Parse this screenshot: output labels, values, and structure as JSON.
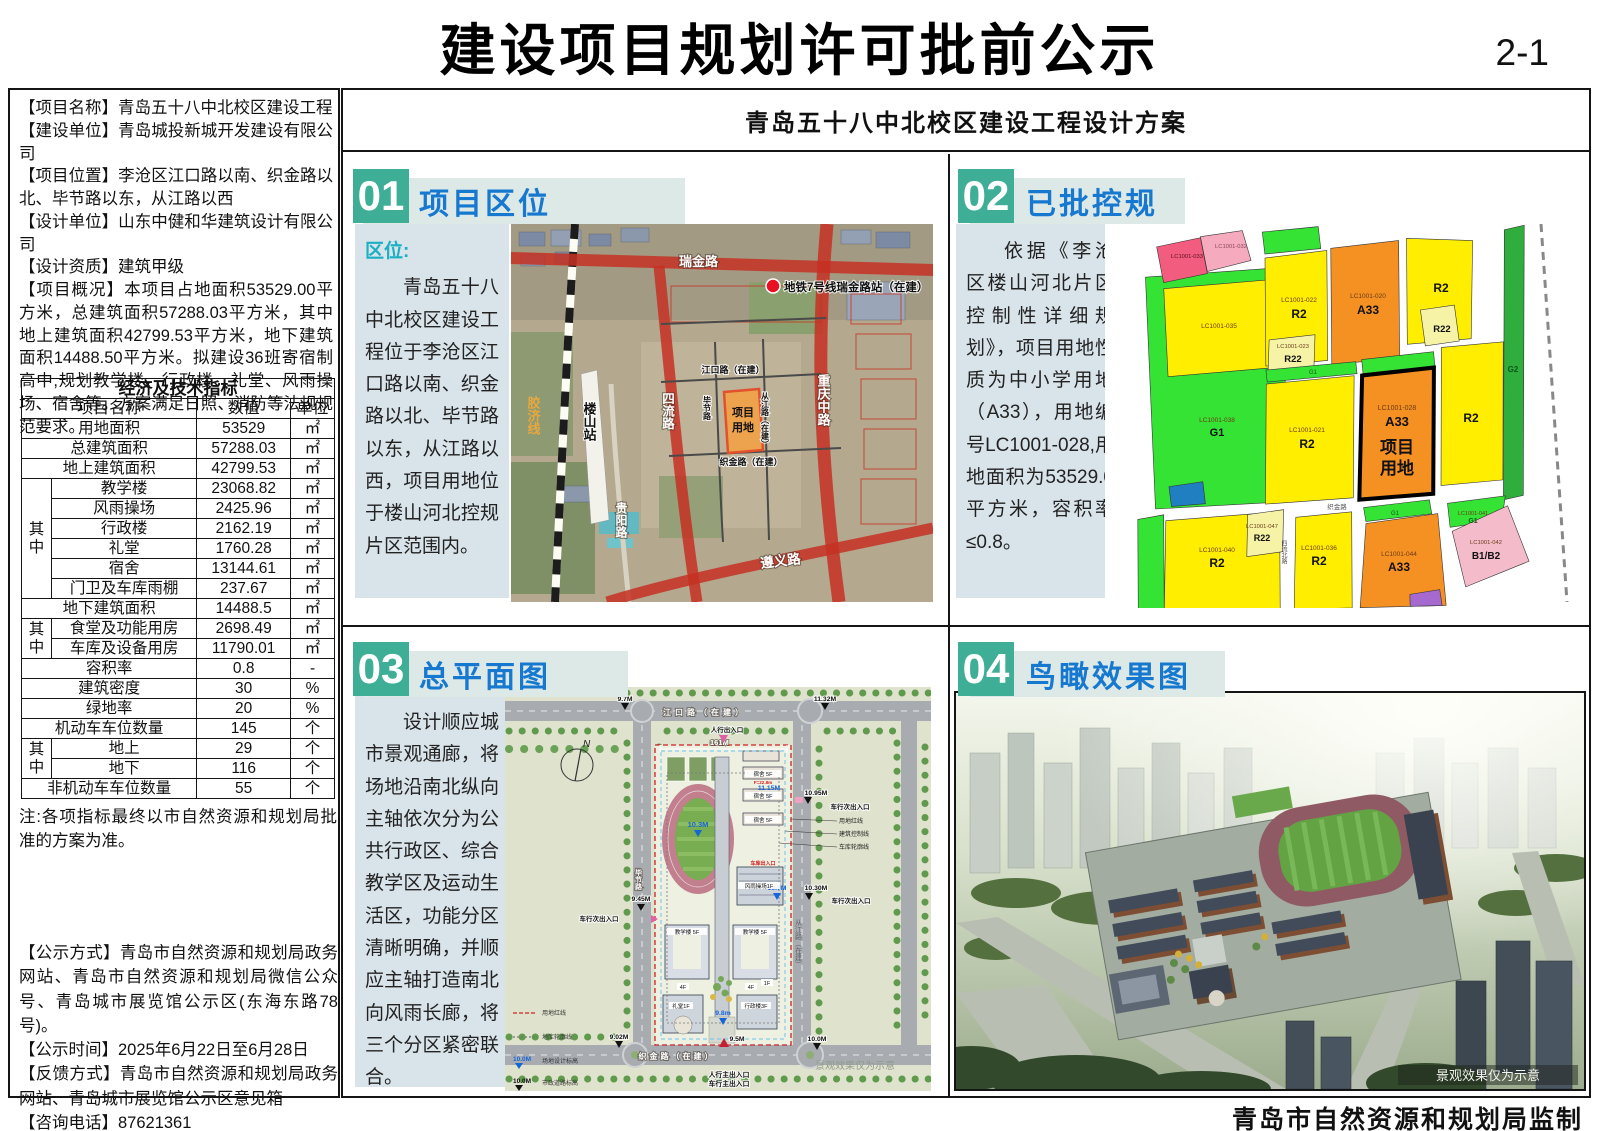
{
  "page": {
    "title": "建设项目规划许可批前公示",
    "page_no": "2-1",
    "subtitle": "青岛五十八中北校区建设工程设计方案",
    "footer": "青岛市自然资源和规划局监制"
  },
  "colors": {
    "badge_teal": "#3fae96",
    "header_blue": "#1778d0",
    "banner_bg": "#dde9e7",
    "card_bg": "#d8e3ea",
    "accent_cyan": "#1ab0c4",
    "zoning": {
      "r2": "#ffee00",
      "r22": "#f6f3a6",
      "a33": "#f59122",
      "g1": "#35e335",
      "g2": "#2fae3e",
      "pink": "#f25c7e",
      "light_pink": "#f5abbd",
      "b1b2": "#f4bcca",
      "blue": "#1f7fc0",
      "purple": "#a569cf"
    }
  },
  "sidebar": {
    "info": [
      {
        "label": "【项目名称】",
        "text": "青岛五十八中北校区建设工程"
      },
      {
        "label": "【建设单位】",
        "text": "青岛城投新城开发建设有限公司"
      },
      {
        "label": "【项目位置】",
        "text": "李沧区江口路以南、织金路以北、毕节路以东，从江路以西"
      },
      {
        "label": "【设计单位】",
        "text": "山东中健和华建筑设计有限公司"
      },
      {
        "label": "【设计资质】",
        "text": "建筑甲级"
      },
      {
        "label": "【项目概况】",
        "text": "本项目占地面积53529.00平方米，总建筑面积57288.03平方米，其中地上建筑面积42799.53平方米，地下建筑面积14488.50平方米。拟建设36班寄宿制高中,规划教学楼、行政楼、礼堂、风雨操场、宿舍等。方案满足日照、消防等法规规范要求。"
      }
    ],
    "table": {
      "title": "经济及技术指标",
      "headers": [
        "项目名称",
        "数值",
        "单位"
      ],
      "rows": [
        {
          "name": "用地面积",
          "value": "53529",
          "unit": "㎡"
        },
        {
          "name": "总建筑面积",
          "value": "57288.03",
          "unit": "㎡"
        },
        {
          "name": "地上建筑面积",
          "value": "42799.53",
          "unit": "㎡"
        },
        {
          "group": "其中",
          "name": "教学楼",
          "value": "23068.82",
          "unit": "㎡"
        },
        {
          "name": "风雨操场",
          "value": "2425.96",
          "unit": "㎡"
        },
        {
          "name": "行政楼",
          "value": "2162.19",
          "unit": "㎡"
        },
        {
          "name": "礼堂",
          "value": "1760.28",
          "unit": "㎡"
        },
        {
          "name": "宿舍",
          "value": "13144.61",
          "unit": "㎡"
        },
        {
          "name": "门卫及车库雨棚",
          "value": "237.67",
          "unit": "㎡"
        },
        {
          "name": "地下建筑面积",
          "value": "14488.5",
          "unit": "㎡"
        },
        {
          "group": "其中",
          "name": "食堂及功能用房",
          "value": "2698.49",
          "unit": "㎡"
        },
        {
          "name": "车库及设备用房",
          "value": "11790.01",
          "unit": "㎡"
        },
        {
          "name": "容积率",
          "value": "0.8",
          "unit": "-"
        },
        {
          "name": "建筑密度",
          "value": "30",
          "unit": "%"
        },
        {
          "name": "绿地率",
          "value": "20",
          "unit": "%"
        },
        {
          "name": "机动车车位数量",
          "value": "145",
          "unit": "个"
        },
        {
          "group": "其中",
          "name": "地上",
          "value": "29",
          "unit": "个"
        },
        {
          "name": "地下",
          "value": "116",
          "unit": "个"
        },
        {
          "name": "非机动车车位数量",
          "value": "55",
          "unit": "个"
        }
      ]
    },
    "note": "注:各项指标最终以市自然资源和规划局批准的方案为准。",
    "notices": [
      {
        "label": "【公示方式】",
        "text": "青岛市自然资源和规划局政务网站、青岛市自然资源和规划局微信公众号、青岛城市展览馆公示区(东海东路78号)。"
      },
      {
        "label": "【公示时间】",
        "text": "2025年6月22日至6月28日"
      },
      {
        "label": "【反馈方式】",
        "text": "青岛市自然资源和规划局政务网站、青岛城市展览馆公示区意见箱"
      },
      {
        "label": "【咨询电话】",
        "text": "87621361"
      }
    ]
  },
  "panels": {
    "p1": {
      "num": "01",
      "title": "项目区位",
      "intro_label": "区位:",
      "intro": "青岛五十八中北校区建设工程位于李沧区江口路以南、织金路以北、毕节路以东，从江路以西，项目用地位于楼山河北控规片区范围内。"
    },
    "p2": {
      "num": "02",
      "title": "已批控规",
      "intro": "依据《李沧区楼山河北片区控制性详细规划》，项目用地性质为中小学用地（A33），用地编号LC1001-028,用地面积为53529.0平方米，容积率≤0.8。"
    },
    "p3": {
      "num": "03",
      "title": "总平面图",
      "intro": "设计顺应城市景观通廊，将场地沿南北纵向主轴依次分为公共行政区、综合教学区及运动生活区，功能分区清晰明确，并顺应主轴打造南北向风雨长廊，将三个分区紧密联合。"
    },
    "p4": {
      "num": "04",
      "title": "鸟瞰效果图",
      "watermark": "景观效果仅为示意"
    }
  },
  "loc_map": {
    "labels": {
      "ruijin": "瑞金路",
      "metro": "地铁7号线瑞金路站（在建）",
      "jiaoji": "胶济线",
      "loushan": "楼山站",
      "siliu": "四流路",
      "chongqing": "重庆中路",
      "jiangkou": "江口路（在建）",
      "zhijin": "织金路（在建）",
      "bijie": "毕节路",
      "congjiang": "从江路（在建）",
      "guiyang": "贵阳路",
      "zunyi": "遵义路",
      "site_l1": "项目",
      "site_l2": "用地"
    }
  },
  "zone_map": {
    "c033": "LC1001-033",
    "c032": "LC1001-032",
    "c035": "LC1001-035",
    "c022": "LC1001-022",
    "u022": "R2",
    "c023": "LC1001-023",
    "u023": "R22",
    "c020": "LC1001-020",
    "u020": "A33",
    "u_tr": "R2",
    "u_tr22": "R22",
    "c038": "LC1001-038",
    "u038": "G1",
    "c021": "LC1001-021",
    "u021": "R2",
    "c028": "LC1001-028",
    "u028": "A33",
    "site_l1": "项目",
    "site_l2": "用地",
    "u_mr": "R2",
    "u_g2": "G2",
    "c040": "LC1001-040",
    "u040": "R2",
    "c047": "LC1001-047",
    "u047": "R22",
    "c036": "LC1001-036",
    "u036": "R2",
    "c044": "LC1001-044",
    "u044": "A33",
    "c041": "LC1001-041",
    "u041": "G1",
    "c042": "LC1001-042",
    "u042": "B1/B2",
    "g1s": "G1",
    "road_zhijin": "织金路",
    "road_siliu": "四流北路"
  },
  "site_plan": {
    "north": "N",
    "dim": "161M",
    "roads": {
      "top": "江口路（在建）",
      "bottom": "织金路（在建）",
      "left": "毕节路",
      "right": "从江路（在建）"
    },
    "entries": {
      "ped": "人行出入口",
      "veh_side": "车行次出入口",
      "ped_main": "人行主出入口",
      "veh_main": "车行主出入口",
      "garage": "车库出入口"
    },
    "callouts": {
      "c1": "用地红线",
      "c2": "建筑控制线",
      "c3": "车库轮廓线"
    },
    "bld": {
      "dorm": "宿舍 5F",
      "dorm_h": "F=22.8m",
      "gym": "风雨操场1F",
      "teach": "教学楼 5F",
      "hall": "礼堂1F",
      "admin": "行政楼3F",
      "f1": "1F",
      "f4": "4F"
    },
    "elev": {
      "e97": "9.7M",
      "e1132": "11.32M",
      "e1115": "11.15M",
      "e1095": "10.95M",
      "e103": "10.3M",
      "e107": "10.7M",
      "e1030": "10.30M",
      "e945": "9.45M",
      "e98": "9.8m",
      "e95": "9.5M",
      "e902": "9.02M",
      "e100": "10.0M"
    },
    "legend": {
      "l1": "用地红线",
      "l2": "地库轮廓线",
      "l3": "场地设计标高",
      "l4": "市政道路标高",
      "v": "10.0M"
    },
    "watermark": "景观效果仅为示意"
  }
}
